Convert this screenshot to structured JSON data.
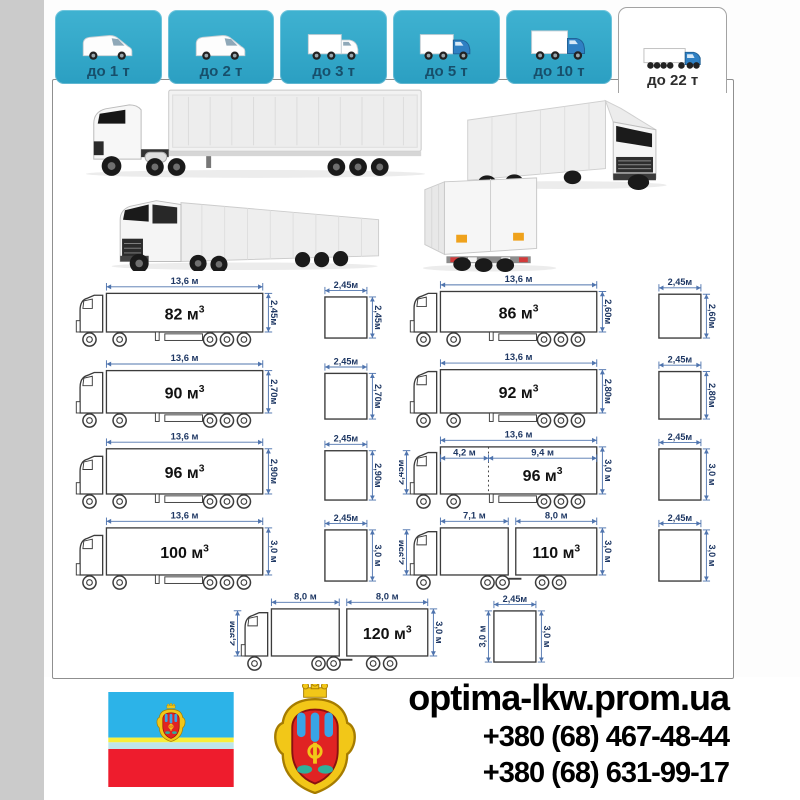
{
  "colors": {
    "tab_teal": "#30a9c9",
    "tab_label": "#174f6b",
    "dimension_line": "#4f74ae",
    "dimension_text": "#1f3864",
    "truck_outline": "#3c3c3c",
    "flag_blue": "#2cb3e8",
    "flag_yellow": "#f8ef3a",
    "flag_cyan": "#bfe6ea",
    "flag_red": "#ee1c2d",
    "arms_gold": "#f2c718",
    "arms_red": "#e02323",
    "arms_blue": "#39a4e6",
    "arms_teal": "#2fae9b",
    "cab_blue": "#2f80c3"
  },
  "tabs": [
    {
      "name": "up-to-1t",
      "label": "до 1 т",
      "icon": "van-icon",
      "active": false
    },
    {
      "name": "up-to-2t",
      "label": "до 2 т",
      "icon": "van-icon",
      "active": false
    },
    {
      "name": "up-to-3t",
      "label": "до 3 т",
      "icon": "box-truck-icon",
      "active": false
    },
    {
      "name": "up-to-5t",
      "label": "до 5 т",
      "icon": "box-truck-blue-icon",
      "active": false
    },
    {
      "name": "up-to-10t",
      "label": "до 10 т",
      "icon": "box-truck-large-icon",
      "active": false
    },
    {
      "name": "up-to-22t",
      "label": "до 22 т",
      "icon": "semi-truck-icon",
      "active": true
    }
  ],
  "diagram_rows": [
    {
      "center": false,
      "items": [
        {
          "kind": "truck",
          "type": "semi",
          "volume": "82",
          "volume_unit": "м",
          "volume_exp": "3",
          "length_label": "13,6 м",
          "height_label": "2,45м",
          "height_m": 2.45
        },
        {
          "kind": "cross",
          "width_label": "2,45м",
          "height_label": "2,45м",
          "height_m": 2.45
        },
        {
          "kind": "truck",
          "type": "semi",
          "volume": "86",
          "volume_unit": "м",
          "volume_exp": "3",
          "length_label": "13,6 м",
          "height_label": "2,60м",
          "height_m": 2.6
        },
        {
          "kind": "cross",
          "width_label": "2,45м",
          "height_label": "2,60м",
          "height_m": 2.6
        }
      ]
    },
    {
      "center": false,
      "items": [
        {
          "kind": "truck",
          "type": "semi",
          "volume": "90",
          "volume_unit": "м",
          "volume_exp": "3",
          "length_label": "13,6 м",
          "height_label": "2,70м",
          "height_m": 2.7
        },
        {
          "kind": "cross",
          "width_label": "2,45м",
          "height_label": "2,70м",
          "height_m": 2.7
        },
        {
          "kind": "truck",
          "type": "semi",
          "volume": "92",
          "volume_unit": "м",
          "volume_exp": "3",
          "length_label": "13,6 м",
          "height_label": "2,80м",
          "height_m": 2.8
        },
        {
          "kind": "cross",
          "width_label": "2,45м",
          "height_label": "2,80м",
          "height_m": 2.8
        }
      ]
    },
    {
      "center": false,
      "items": [
        {
          "kind": "truck",
          "type": "semi",
          "volume": "96",
          "volume_unit": "м",
          "volume_exp": "3",
          "length_label": "13,6 м",
          "height_label": "2,90м",
          "height_m": 2.9
        },
        {
          "kind": "cross",
          "width_label": "2,45м",
          "height_label": "2,90м",
          "height_m": 2.9
        },
        {
          "kind": "truck",
          "type": "semi-split",
          "volume": "96",
          "volume_unit": "м",
          "volume_exp": "3",
          "length_label": "13,6 м",
          "split_labels": [
            "4,2 м",
            "9,4 м"
          ],
          "split_ratio": 0.309,
          "cab_label": "2,45м",
          "height_label": "3,0 м",
          "height_m": 3.0
        },
        {
          "kind": "cross",
          "width_label": "2,45м",
          "height_label": "3,0 м",
          "height_m": 3.0
        }
      ]
    },
    {
      "center": false,
      "items": [
        {
          "kind": "truck",
          "type": "semi",
          "volume": "100",
          "volume_unit": "м",
          "volume_exp": "3",
          "length_label": "13,6 м",
          "height_label": "3,0 м",
          "height_m": 3.0
        },
        {
          "kind": "cross",
          "width_label": "2,45м",
          "height_label": "3,0 м",
          "height_m": 3.0
        },
        {
          "kind": "truck",
          "type": "tandem",
          "volume": "110",
          "volume_unit": "м",
          "volume_exp": "3",
          "seg_labels": [
            "7,1 м",
            "8,0 м"
          ],
          "cab_label": "2,95м",
          "height_label": "3,0 м",
          "height_m": 3.0
        },
        {
          "kind": "cross",
          "width_label": "2,45м",
          "height_label": "3,0 м",
          "height_m": 3.0
        }
      ]
    },
    {
      "center": true,
      "items": [
        {
          "kind": "truck",
          "type": "tandem",
          "volume": "120",
          "volume_unit": "м",
          "volume_exp": "3",
          "seg_labels": [
            "8,0 м",
            "8,0 м"
          ],
          "cab_label": "2,95м",
          "height_label": "3,0 м",
          "height_m": 3.0
        },
        {
          "kind": "cross",
          "width_label": "2,45м",
          "height_label": "3,0 м",
          "left_label": "3,0 м",
          "height_m": 3.0
        }
      ]
    }
  ],
  "footer": {
    "site": "optima-lkw.prom.ua",
    "phone1": "+380 (68) 467-48-44",
    "phone2": "+380 (68) 631-99-17"
  }
}
